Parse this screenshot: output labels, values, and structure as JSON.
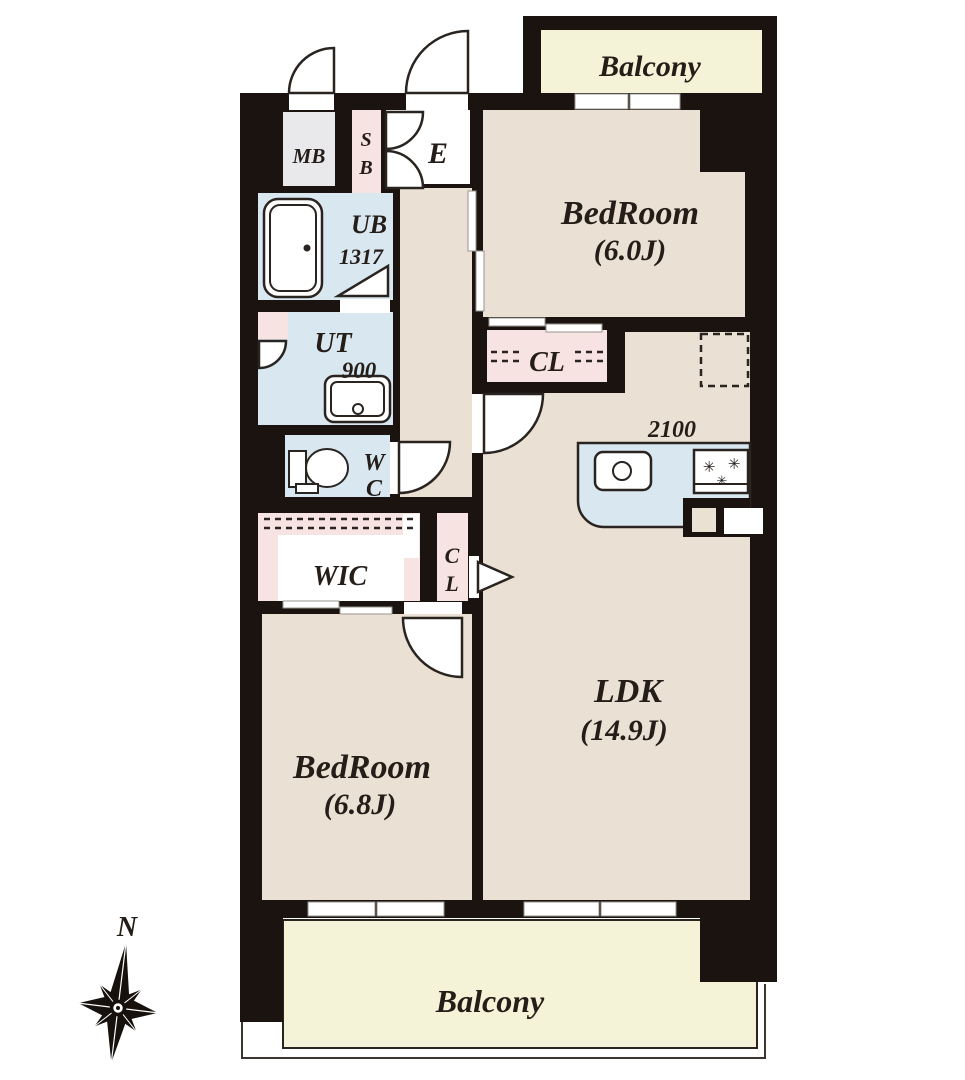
{
  "floorplan": {
    "compass": {
      "north_label": "N"
    },
    "balcony_top": {
      "label": "Balcony"
    },
    "balcony_bottom": {
      "label": "Balcony"
    },
    "rooms": {
      "meter_box": {
        "label": "MB"
      },
      "shoe_box": {
        "line1": "S",
        "line2": "B"
      },
      "entrance": {
        "label": "E"
      },
      "bedroom_1": {
        "name": "BedRoom",
        "size": "(6.0J)"
      },
      "unit_bath": {
        "name": "UB",
        "size": "1317"
      },
      "utility": {
        "name": "UT",
        "size": "900"
      },
      "toilet": {
        "line1": "W",
        "line2": "C"
      },
      "closet_bedroom1": {
        "label": "CL"
      },
      "walk_in_closet": {
        "label": "WIC"
      },
      "closet_hall": {
        "line1": "C",
        "line2": "L"
      },
      "ldk": {
        "name": "LDK",
        "size": "(14.9J)"
      },
      "bedroom_2": {
        "name": "BedRoom",
        "size": "(6.8J)"
      },
      "kitchen": {
        "counter_width": "2100"
      }
    },
    "colors": {
      "wall": "#1a130f",
      "floor": "#eae1d4",
      "wet": "#d8e7f0",
      "closet": "#f7e3e1",
      "balcony": "#f5f3d7",
      "meter": "#e9e9ec",
      "text": "#241d18",
      "line": "#2a2420"
    }
  }
}
